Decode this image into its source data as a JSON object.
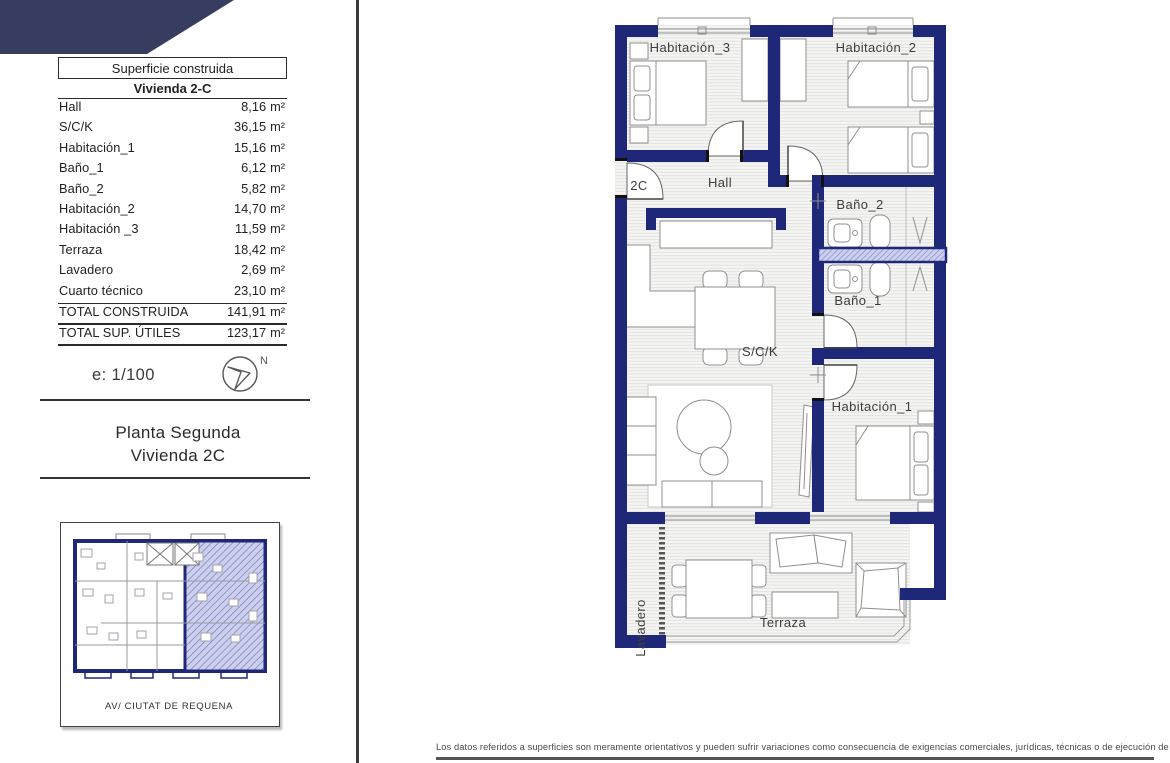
{
  "colors": {
    "wall_navy": "#1f2878",
    "corner_slate": "#363d60",
    "keyplan_highlight": "#cdd0ed",
    "floor_line": "#e0e0de"
  },
  "left_panel": {
    "area_table": {
      "header": "Superficie construida",
      "subheader": "Vivienda 2-C",
      "rows": [
        {
          "label": "Hall",
          "value": "8,16",
          "unit": "m²"
        },
        {
          "label": "S/C/K",
          "value": "36,15",
          "unit": "m²"
        },
        {
          "label": "Habitación_1",
          "value": "15,16",
          "unit": "m²"
        },
        {
          "label": "Baño_1",
          "value": "6,12",
          "unit": "m²"
        },
        {
          "label": "Baño_2",
          "value": "5,82",
          "unit": "m²"
        },
        {
          "label": "Habitación_2",
          "value": "14,70",
          "unit": "m²"
        },
        {
          "label": "Habitación _3",
          "value": "11,59",
          "unit": "m²"
        },
        {
          "label": "Terraza",
          "value": "18,42",
          "unit": "m²"
        },
        {
          "label": "Lavadero",
          "value": "2,69",
          "unit": "m²"
        },
        {
          "label": "Cuarto técnico",
          "value": "23,10",
          "unit": "m²"
        },
        {
          "label": "TOTAL CONSTRUIDA",
          "value": "141,91",
          "unit": "m²"
        },
        {
          "label": "TOTAL SUP. ÚTILES",
          "value": "123,17",
          "unit": "m²"
        }
      ]
    },
    "scale_text": "e: 1/100",
    "north_label": "N",
    "plan_title_line1": "Planta Segunda",
    "plan_title_line2": "Vivienda 2C",
    "keyplan": {
      "caption": "AV/ CIUTAT DE REQUENA"
    }
  },
  "floor_plan": {
    "room_labels": {
      "habitacion_3": "Habitación_3",
      "habitacion_2": "Habitación_2",
      "hall": "Hall",
      "unit_tag": "2C",
      "bano_2": "Baño_2",
      "bano_1": "Baño_1",
      "sck": "S/C/K",
      "habitacion_1": "Habitación_1",
      "lavadero": "Lavadero",
      "terraza": "Terraza"
    }
  },
  "footer": {
    "disclaimer": "Los datos referidos a superficies son meramente orientativos y pueden sufrir variaciones como consecuencia de exigencias comerciales, jurídicas, técnicas o de ejecución de proyecto."
  }
}
